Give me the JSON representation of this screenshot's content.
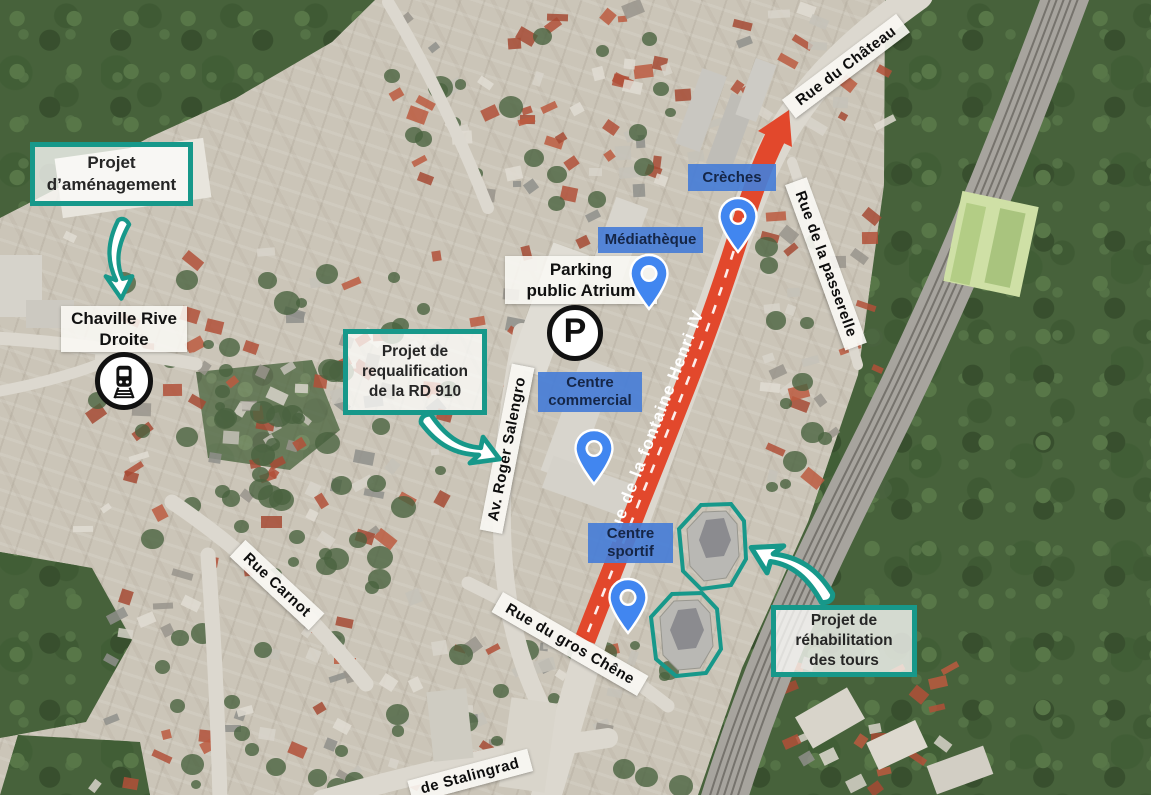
{
  "map_colors": {
    "project_border": "#17988a",
    "project_text": "#262626",
    "facility_bg": "rgba(72,126,214,0.93)",
    "facility_text": "#152647",
    "pin_fill": "#4186f0",
    "road_highlight": "#e2482c"
  },
  "project_boxes": [
    {
      "id": "amenagement",
      "label": "Projet\nd’aménagement"
    },
    {
      "id": "rd910",
      "label": "Projet de\nrequalification\nde la RD 910"
    },
    {
      "id": "tours",
      "label": "Projet de\nréhabilitation\ndes tours"
    }
  ],
  "facilities": [
    {
      "id": "creches",
      "label": "Crèches"
    },
    {
      "id": "mediatheque",
      "label": "Médiathèque"
    },
    {
      "id": "commercial",
      "label": "Centre\ncommercial"
    },
    {
      "id": "sportif",
      "label": "Centre\nsportif"
    }
  ],
  "station": {
    "label": "Chaville Rive\nDroite"
  },
  "parking": {
    "label": "Parking\npublic Atrium",
    "icon_letter": "P"
  },
  "road_highlight": {
    "label": "Rue de la fontaine Henri IV"
  },
  "streets": [
    {
      "id": "chateau",
      "label": "Rue du Château"
    },
    {
      "id": "passerelle",
      "label": "Rue de la passerelle"
    },
    {
      "id": "salengro",
      "label": "Av. Roger Salengro"
    },
    {
      "id": "carnot",
      "label": "Rue Carnot"
    },
    {
      "id": "gros-chene",
      "label": "Rue du gros Chêne"
    },
    {
      "id": "stalingrad",
      "label": "de Stalingrad"
    }
  ]
}
